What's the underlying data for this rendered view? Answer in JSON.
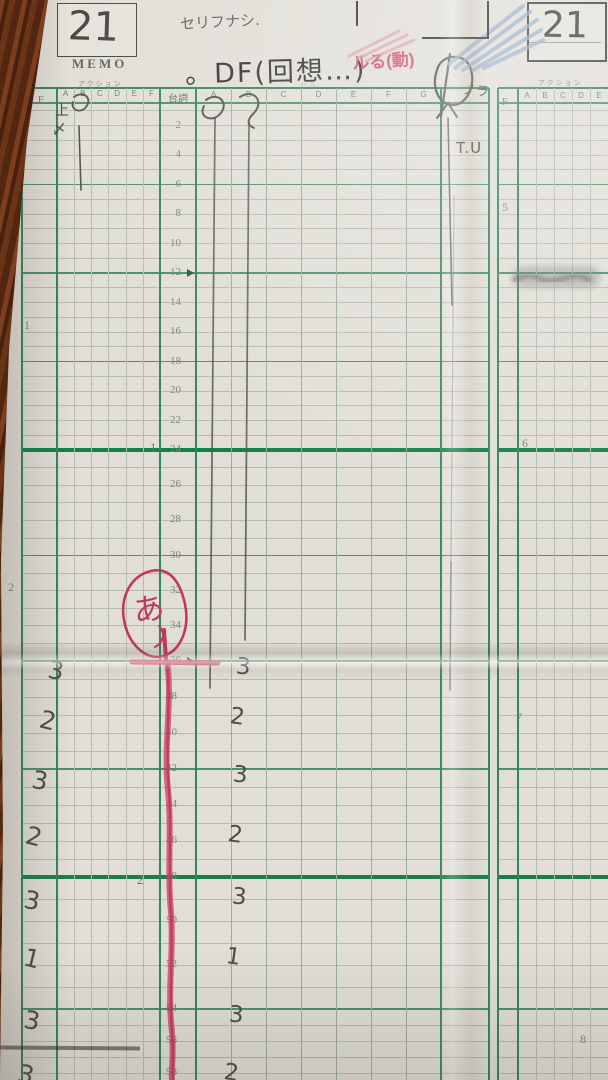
{
  "header": {
    "memo_label": "MEMO",
    "cut_number": "21",
    "cut_number_right": "21",
    "pencil_note": "セリフナシ.",
    "title": "。DF(回想…)",
    "red_note": "ルる(動)",
    "nora_note": "ノラ"
  },
  "columns": {
    "f_label": "F",
    "right_f_label": "F",
    "action_label": "アクション",
    "right_action_label": "アクション",
    "cell_label": "セル",
    "camera_label": "カメラ",
    "dialogue_label": "台詞",
    "action_letters": [
      "A",
      "B",
      "C",
      "D",
      "E",
      "F"
    ],
    "cell_letters": [
      "A",
      "B",
      "C",
      "D",
      "E",
      "F",
      "G"
    ],
    "right_action_letters": [
      "A",
      "B",
      "C",
      "D",
      "E",
      "F"
    ]
  },
  "timeline": {
    "frame_labels": [
      2,
      4,
      6,
      8,
      10,
      12,
      14,
      16,
      18,
      20,
      22,
      24,
      26,
      28,
      30,
      32,
      34,
      36,
      38,
      40,
      42,
      44,
      46,
      48,
      50,
      52,
      54,
      56,
      58
    ],
    "half_second_triangles": [
      12,
      36
    ],
    "second_marks": [
      {
        "label": "1",
        "x": 150,
        "y": 440
      },
      {
        "label": "2",
        "x": 137,
        "y": 872
      }
    ],
    "left_margin_feet": [
      {
        "label": "1",
        "x": 24,
        "y": 318
      },
      {
        "label": "2",
        "x": 8,
        "y": 580
      }
    ],
    "right_margin_feet": [
      {
        "label": "5",
        "x": 502,
        "y": 200
      },
      {
        "label": "6",
        "x": 522,
        "y": 436
      },
      {
        "label": "7",
        "x": 516,
        "y": 710
      },
      {
        "label": "8",
        "x": 580,
        "y": 1032
      }
    ]
  },
  "handwriting": {
    "camera_move": "T.U",
    "lip_sync": "あ",
    "top_left_mark1": "上",
    "top_left_mark2": "〆",
    "left_counts": [
      {
        "t": "3",
        "x": 48,
        "y": 656
      },
      {
        "t": "2",
        "x": 40,
        "y": 706
      },
      {
        "t": "3",
        "x": 32,
        "y": 766
      },
      {
        "t": "2",
        "x": 26,
        "y": 822
      },
      {
        "t": "3",
        "x": 24,
        "y": 886
      },
      {
        "t": "1",
        "x": 24,
        "y": 944
      },
      {
        "t": "3",
        "x": 24,
        "y": 1006
      },
      {
        "t": "3",
        "x": 18,
        "y": 1060
      }
    ],
    "middle_counts": [
      {
        "t": "3",
        "x": 236,
        "y": 654
      },
      {
        "t": "2",
        "x": 230,
        "y": 704
      },
      {
        "t": "3",
        "x": 233,
        "y": 762
      },
      {
        "t": "2",
        "x": 228,
        "y": 822
      },
      {
        "t": "3",
        "x": 232,
        "y": 884
      },
      {
        "t": "1",
        "x": 226,
        "y": 944
      },
      {
        "t": "3",
        "x": 229,
        "y": 1002
      },
      {
        "t": "2",
        "x": 224,
        "y": 1060
      }
    ]
  },
  "colors": {
    "thick_line": "#15814a",
    "medium_line": "#4a9068",
    "border_line": "#35855c",
    "thin_line": "#b3bdaf",
    "red_crayon": "#c4385a",
    "pencil": "#54544e",
    "blue_pencil": "#8fa9cc",
    "paper": "#e1ded7"
  }
}
